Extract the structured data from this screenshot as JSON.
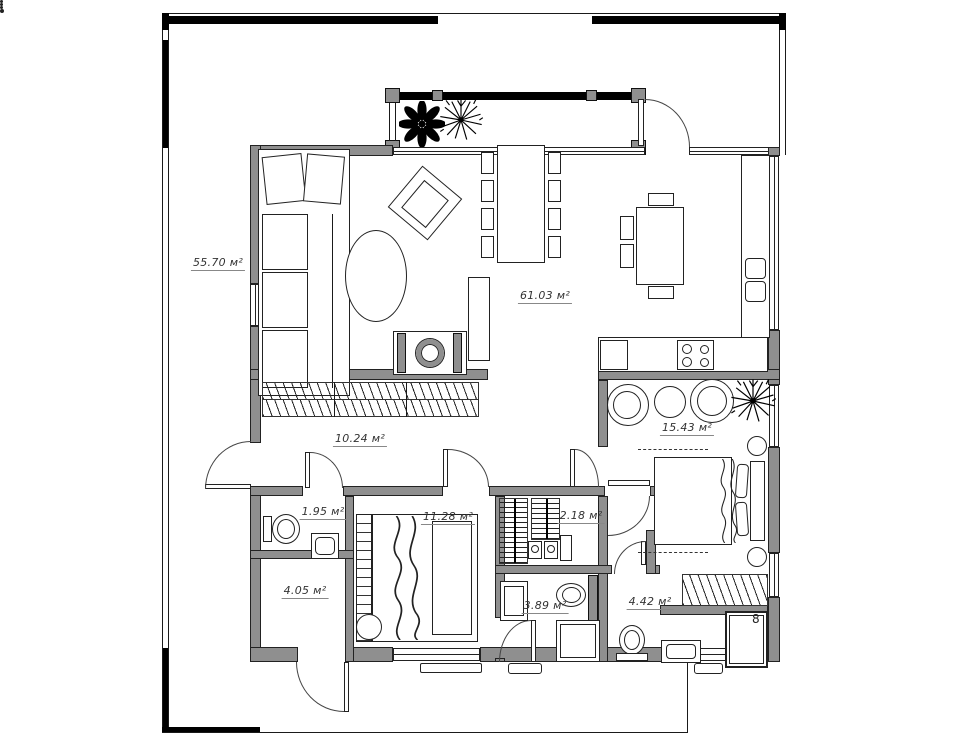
{
  "plan": {
    "name": "house-floor-plan",
    "unit": "м²",
    "rooms": [
      {
        "name": "terrace",
        "area": "55.70 м²"
      },
      {
        "name": "living-dining-kitchen",
        "area": "61.03 м²"
      },
      {
        "name": "hallway",
        "area": "10.24 м²"
      },
      {
        "name": "wc",
        "area": "1.95 м²"
      },
      {
        "name": "bedroom-small",
        "area": "11.28 м²"
      },
      {
        "name": "wardrobe",
        "area": "2.18 м²"
      },
      {
        "name": "bedroom-master",
        "area": "15.43 м²"
      },
      {
        "name": "storage",
        "area": "4.05 м²"
      },
      {
        "name": "bathroom",
        "area": "3.89 м²"
      },
      {
        "name": "shower-room",
        "area": "4.42 м²"
      }
    ],
    "symbols": {
      "shower_head": "8"
    },
    "colors": {
      "wall": "#8f8f8f",
      "line": "#1a1a1a",
      "black": "#000000",
      "background": "#ffffff"
    }
  }
}
